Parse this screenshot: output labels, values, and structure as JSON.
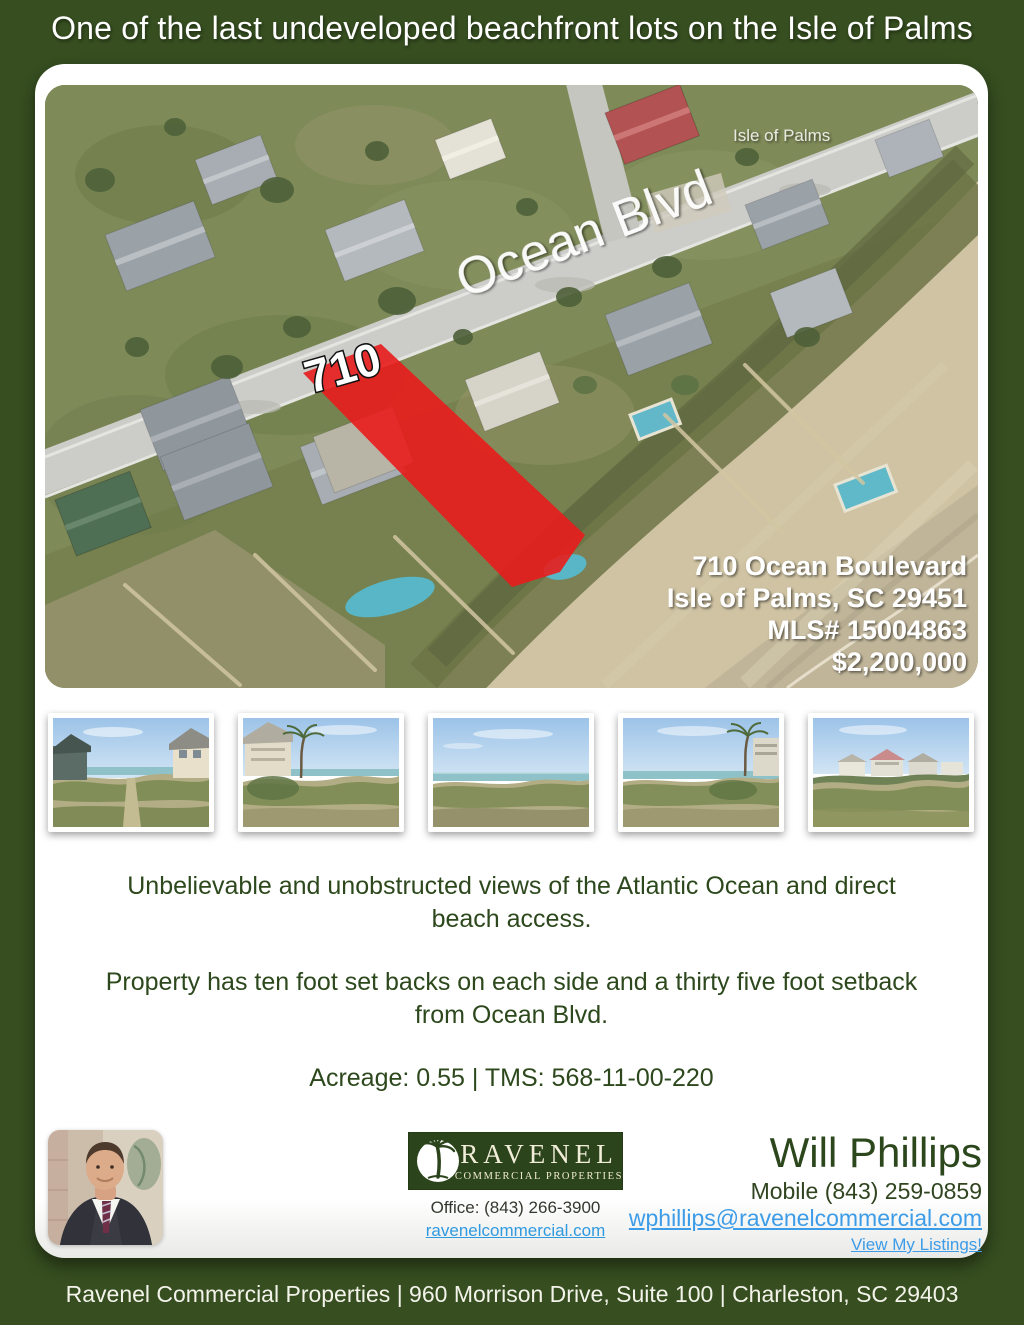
{
  "header": {
    "title": "One of the last undeveloped beachfront lots on the Isle of Palms"
  },
  "map": {
    "road_label": "Ocean Blvd",
    "area_label": "Isle of Palms",
    "lot_number": "710",
    "address_line1": "710 Ocean Boulevard",
    "address_line2": "Isle of Palms, SC 29451",
    "mls_line": "MLS# 15004863",
    "price_line": "$2,200,000"
  },
  "gallery": {
    "items": [
      {
        "label": "beach-access-path-between-houses"
      },
      {
        "label": "dune-with-beach-house-and-palm"
      },
      {
        "label": "open-dunes-ocean-view"
      },
      {
        "label": "dunes-with-palm-and-walkover"
      },
      {
        "label": "dunes-with-beachfront-houses"
      }
    ]
  },
  "description": {
    "para1": "Unbelievable and unobstructed views of the Atlantic Ocean and direct\nbeach access.",
    "para2": "Property has ten foot set backs on each side and a thirty five foot setback\nfrom Ocean Blvd.",
    "details": "Acreage: 0.55 | TMS: 568-11-00-220"
  },
  "contact": {
    "brand_name": "RAVENEL",
    "brand_tagline": "COMMERCIAL PROPERTIES",
    "office_phone": "Office: (843) 266-3900",
    "website_link": "ravenelcommercial.com",
    "agent_name": "Will Phillips",
    "mobile_phone": "Mobile (843) 259-0859",
    "email_link": "wphillips@ravenelcommercial.com",
    "listings_link": "View My Listings!"
  },
  "footer": {
    "text": "Ravenel Commercial Properties | 960 Morrison Drive, Suite 100 | Charleston, SC 29403"
  },
  "colors": {
    "page_green": "#364e20",
    "lot_red": "#e91c1c",
    "link_blue": "#3c9ce8",
    "text_green": "#2c481c"
  }
}
